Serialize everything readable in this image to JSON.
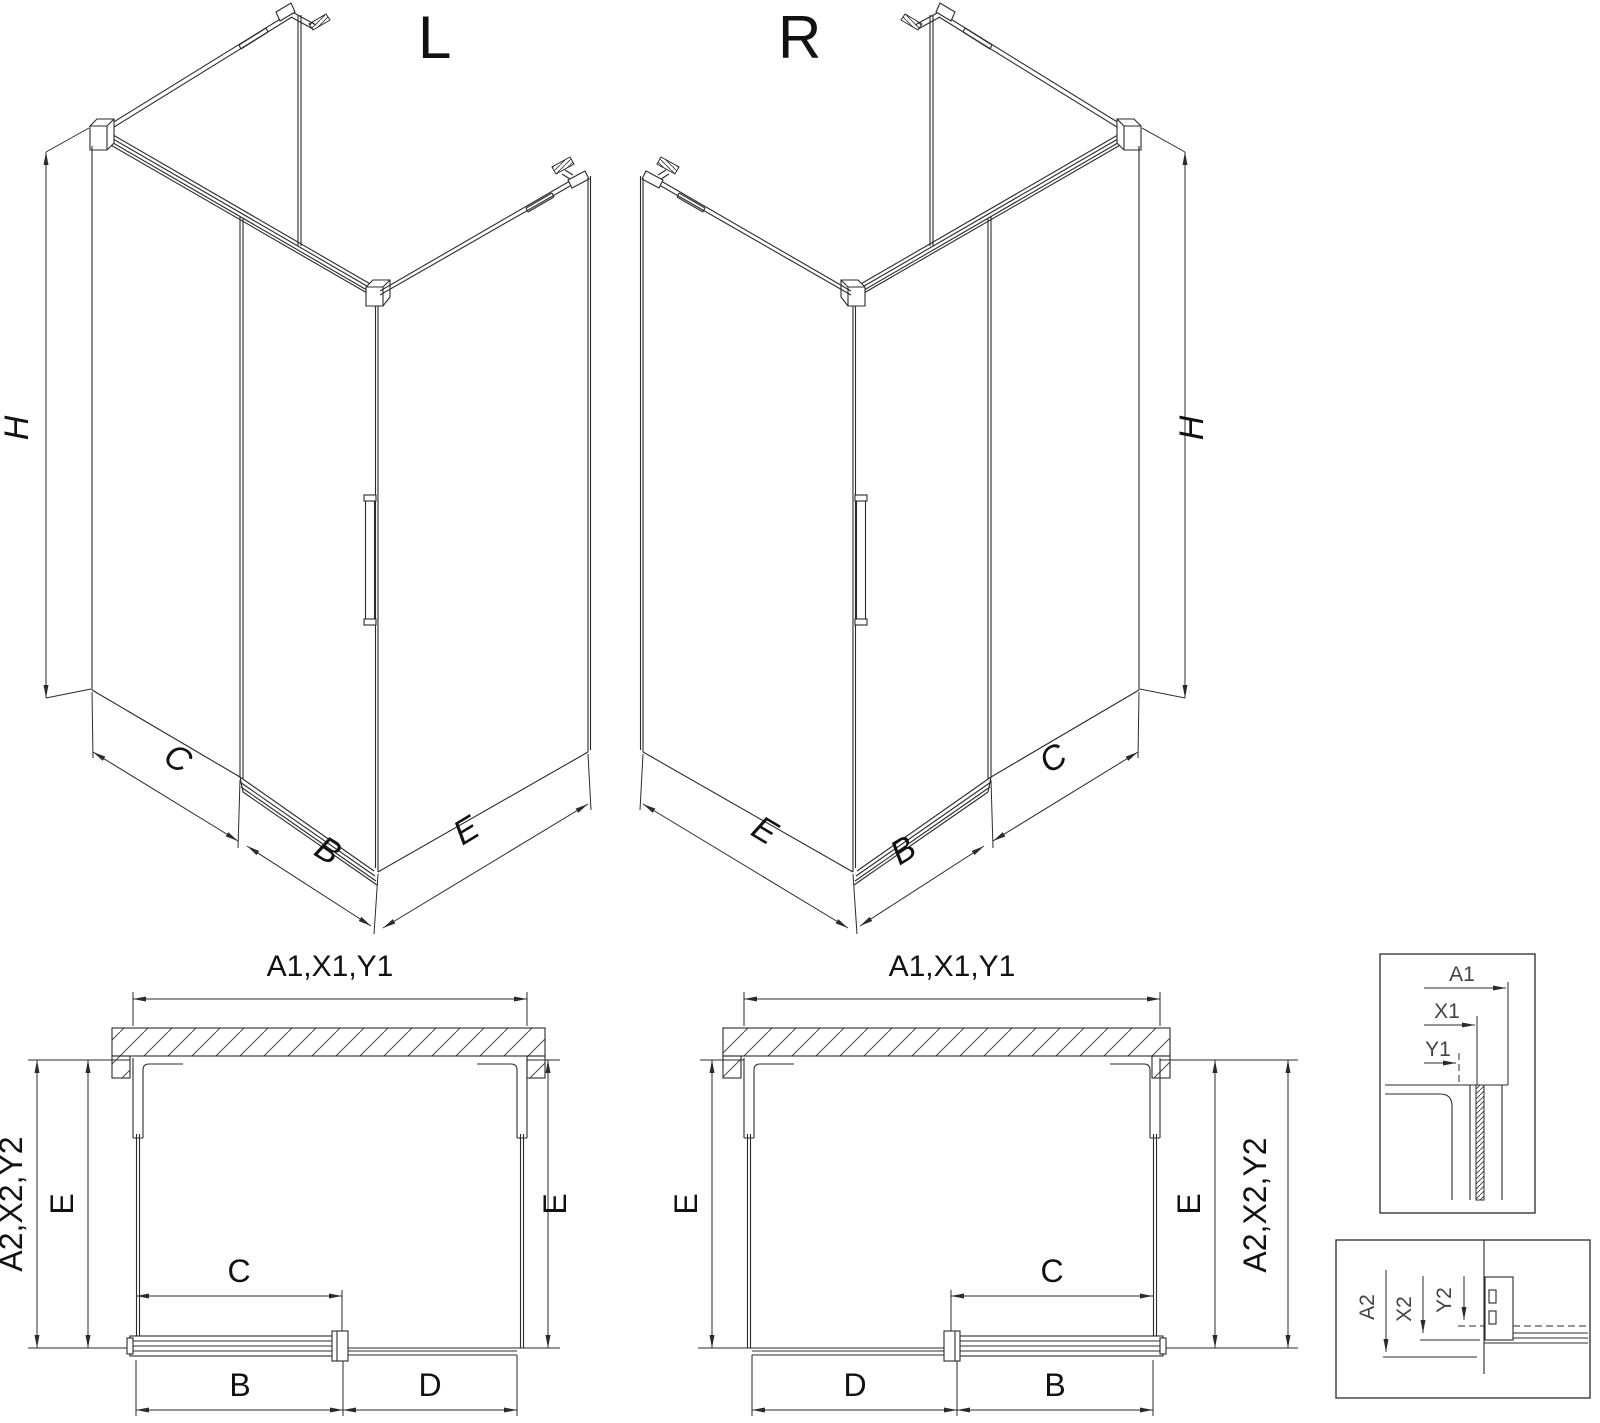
{
  "drawing": {
    "iso_left": {
      "label": "L",
      "dim_height": "H",
      "dim_side": "C",
      "dim_door": "B",
      "dim_return": "E"
    },
    "iso_right": {
      "label": "R",
      "dim_height": "H",
      "dim_side": "C",
      "dim_door": "B",
      "dim_return": "E"
    },
    "plan_left": {
      "dim_top": "A1,X1,Y1",
      "dim_left_outer": "A2,X2,Y2",
      "dim_left": "E",
      "dim_right": "E",
      "dim_opening": "C",
      "dim_door": "B",
      "dim_fixed": "D"
    },
    "plan_right": {
      "dim_top": "A1,X1,Y1",
      "dim_right_outer": "A2,X2,Y2",
      "dim_left": "E",
      "dim_right": "E",
      "dim_opening": "C",
      "dim_door": "B",
      "dim_fixed": "D"
    },
    "detail_top": {
      "dims": [
        "A1",
        "X1",
        "Y1"
      ]
    },
    "detail_bottom": {
      "dims": [
        "A2",
        "X2",
        "Y2"
      ]
    }
  }
}
